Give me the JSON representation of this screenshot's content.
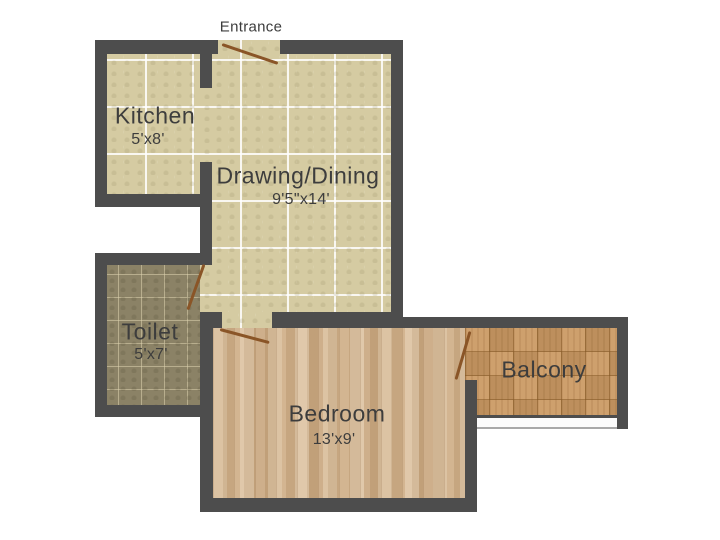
{
  "entrance_label": "Entrance",
  "rooms": [
    {
      "name": "Kitchen",
      "dimensions": "5'x8'"
    },
    {
      "name": "Drawing/Dining",
      "dimensions": "9'5\"x14'"
    },
    {
      "name": "Toilet",
      "dimensions": "5'x7'"
    },
    {
      "name": "Bedroom",
      "dimensions": "13'x9'"
    },
    {
      "name": "Balcony",
      "dimensions": ""
    }
  ],
  "colors": {
    "wall": "#4d4d4d",
    "tile_floor": "#d5cba2",
    "tile_grout": "#f2ecd8",
    "toilet_floor": "#8b8266",
    "bedroom_floor": "#d2b38f",
    "balcony_floor": "#cb9a64",
    "door": "#8a5527",
    "text": "#3d3d3d",
    "background": "#ffffff"
  }
}
